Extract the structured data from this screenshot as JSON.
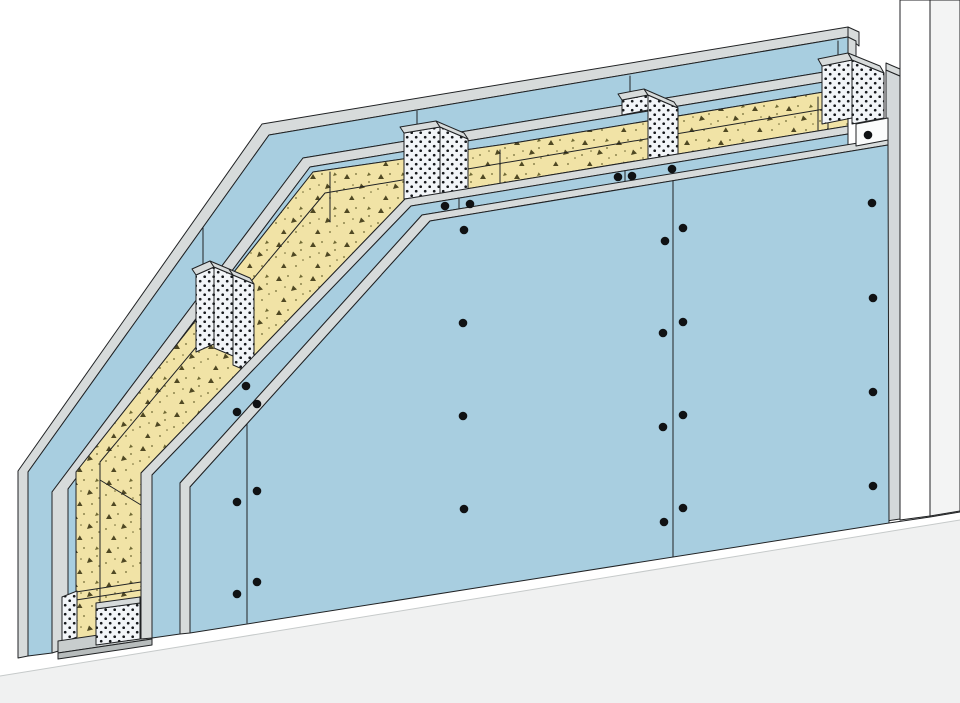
{
  "figure": {
    "kind": "technical-cutaway-diagram",
    "subject": "drywall-partition-wall-assembly",
    "canvas": {
      "width": 960,
      "height": 703
    }
  },
  "colors": {
    "outline": "#202224",
    "board": "#a8cee0",
    "edge": "#d7dbdb",
    "insulation": "#f1e3a6",
    "speckle": "#4f4823",
    "speckleDot": "#6f6833",
    "studBg": "#f2f5f8",
    "studDot": "#16191c",
    "wallStrip": "#d3d8da",
    "reveal": "#ffffff",
    "wallFace": "#f3f4f4",
    "floorWhite": "#ffffff",
    "floorGray": "#f0f1f1",
    "floorLine": "#c6caca",
    "track": "#c8cdcd",
    "trackDark": "#b7bcbc",
    "boxWhite": "#fbfcfc",
    "screw": "#101214"
  },
  "illustration": {
    "layers": [
      {
        "name": "existing-wall",
        "shapes": [
          {
            "name": "existing-wall-reveal",
            "type": "polygon",
            "points": "900,0 930,0 930,516 900,520",
            "fill": "reveal"
          },
          {
            "name": "existing-wall-face",
            "type": "polygon",
            "points": "930,0 960,0 960,511 930,516",
            "fill": "wallFace"
          },
          {
            "name": "existing-wall-edge-strip",
            "type": "polygon",
            "points": "886,70 900,76 900,519 886,521",
            "fill": "wallStrip"
          },
          {
            "name": "existing-wall-edge-cap",
            "type": "polygon",
            "points": "886,70 900,76 900,69 886,63",
            "fill": "edge"
          }
        ]
      },
      {
        "name": "floor",
        "shapes": [
          {
            "name": "floor-white-band",
            "type": "polygon",
            "points": "20,658 190,633 889,523 930,517 960,512 960,520 0,676",
            "fill": "floorWhite",
            "stroke": "none"
          },
          {
            "name": "floor-gray-area",
            "type": "polygon",
            "points": "0,676 960,520 960,703 0,703",
            "fill": "floorGray",
            "stroke": "none"
          },
          {
            "name": "floor-edge-line",
            "type": "polyline",
            "points": "889,523 930,517 960,512",
            "fill": "none"
          },
          {
            "name": "floor-zone-line",
            "type": "polyline",
            "points": "0,676 960,520",
            "fill": "none",
            "stroke": "floorLine"
          }
        ]
      },
      {
        "name": "back-boards",
        "shapes": [
          {
            "name": "back-outer-board-top-edge",
            "type": "polygon",
            "points": "848,27 262,124 18,471 18,658 28,656 28,472 269,135 848,37",
            "fill": "edge"
          },
          {
            "name": "back-outer-board-face",
            "type": "polygon",
            "points": "848,37 269,135 28,472 28,656 52,653 52,492 303,158 848,68",
            "fill": "board"
          },
          {
            "name": "back-board-joint-1",
            "type": "polyline",
            "points": "417,111 417,131",
            "fill": "none"
          },
          {
            "name": "back-board-joint-2",
            "type": "polyline",
            "points": "630,76 630,96",
            "fill": "none"
          },
          {
            "name": "back-board-joint-3",
            "type": "polyline",
            "points": "838,41 838,57",
            "fill": "none"
          },
          {
            "name": "back-board-joint-4",
            "type": "polyline",
            "points": "203,228 203,275",
            "fill": "none"
          },
          {
            "name": "back-inner-board-top-edge",
            "type": "polygon",
            "points": "848,68 303,158 52,492 52,653 68,648 68,489 310,167 848,78",
            "fill": "edge"
          },
          {
            "name": "back-inner-board-face",
            "type": "polygon",
            "points": "848,78 310,167 68,489 68,648 76,646 76,472 313,172 520,142 848,88",
            "fill": "board"
          }
        ]
      },
      {
        "name": "insulation",
        "shapes": [
          {
            "name": "mineral-wool-band",
            "type": "polygon",
            "points": "848,88 520,142 313,172 76,472 76,640 141,640 141,473 405,199 848,126",
            "fill": "insulPattern"
          },
          {
            "name": "mineral-wool-arris-line",
            "type": "polyline",
            "points": "848,105 325,193 100,462 100,618",
            "fill": "none"
          },
          {
            "name": "mineral-wool-fold-line",
            "type": "polyline",
            "points": "330,172 330,222",
            "fill": "none"
          },
          {
            "name": "batt-joint-1",
            "type": "polyline",
            "points": "500,150 500,183",
            "fill": "none"
          },
          {
            "name": "batt-joint-2",
            "type": "polyline",
            "points": "818,97 818,130",
            "fill": "none"
          },
          {
            "name": "batt-joint-3",
            "type": "polyline",
            "points": "828,96 828,129",
            "fill": "none"
          },
          {
            "name": "batt-joint-4",
            "type": "polyline",
            "points": "100,480 141,505",
            "fill": "none"
          },
          {
            "name": "batt-end-line-1",
            "type": "polyline",
            "points": "76,592 141,582",
            "fill": "none"
          },
          {
            "name": "batt-end-line-2",
            "type": "polyline",
            "points": "76,600 141,590",
            "fill": "none"
          }
        ]
      },
      {
        "name": "studs",
        "shapes": [
          {
            "name": "stud-left-flange",
            "type": "polygon",
            "points": "196,275 214,267 214,344 196,352",
            "fill": "studPattern"
          },
          {
            "name": "stud-left-web",
            "type": "polygon",
            "points": "214,267 233,275 233,356 214,348",
            "fill": "studPattern"
          },
          {
            "name": "stud-left-flange-2",
            "type": "polygon",
            "points": "233,275 254,284 254,374 233,365",
            "fill": "studPattern"
          },
          {
            "name": "stud-left-cap-1",
            "type": "polygon",
            "points": "196,275 214,267 210,261 192,269",
            "fill": "edge"
          },
          {
            "name": "stud-left-cap-2",
            "type": "polygon",
            "points": "214,267 233,275 229,269 210,261",
            "fill": "edge"
          },
          {
            "name": "stud-left-cap-3",
            "type": "polygon",
            "points": "233,275 254,284 250,278 229,269",
            "fill": "edge"
          },
          {
            "name": "stud-mid-flange",
            "type": "polygon",
            "points": "404,133 440,127 440,194 404,199",
            "fill": "studPattern"
          },
          {
            "name": "stud-mid-web",
            "type": "polygon",
            "points": "440,127 468,139 468,189 440,194",
            "fill": "studPattern"
          },
          {
            "name": "stud-mid-cap-1",
            "type": "polygon",
            "points": "404,133 440,127 436,121 400,127",
            "fill": "edge"
          },
          {
            "name": "stud-mid-cap-2",
            "type": "polygon",
            "points": "440,127 468,139 464,133 436,121",
            "fill": "edge"
          },
          {
            "name": "stud-right-flange",
            "type": "polygon",
            "points": "622,100 648,95 648,110 622,115",
            "fill": "studPattern"
          },
          {
            "name": "stud-right-web",
            "type": "polygon",
            "points": "648,95 678,108 678,154 648,159",
            "fill": "studPattern"
          },
          {
            "name": "stud-right-cap-1",
            "type": "polygon",
            "points": "622,100 648,95 644,89 618,94",
            "fill": "edge"
          },
          {
            "name": "stud-right-cap-2",
            "type": "polygon",
            "points": "648,95 678,108 674,102 644,89",
            "fill": "edge"
          }
        ]
      },
      {
        "name": "floor-track",
        "shapes": [
          {
            "name": "track-back-flange",
            "type": "polygon",
            "points": "62,597 77,591 77,637 62,643",
            "fill": "studPattern"
          },
          {
            "name": "track-web",
            "type": "polygon",
            "points": "58,641 152,627 152,639 58,653",
            "fill": "track"
          },
          {
            "name": "track-front-lip",
            "type": "polygon",
            "points": "58,653 152,639 152,645 58,659",
            "fill": "trackDark"
          },
          {
            "name": "stud-base-section",
            "type": "polygon",
            "points": "96,609 140,603 140,639 96,645",
            "fill": "studPattern"
          },
          {
            "name": "stud-base-cap",
            "type": "polygon",
            "points": "96,609 140,603 140,597 96,603",
            "fill": "edge"
          }
        ]
      },
      {
        "name": "front-boards",
        "shapes": [
          {
            "name": "front-inner-board-top-edge",
            "type": "polygon",
            "points": "848,126 405,199 141,473 141,639 152,638 152,475 411,206 848,134",
            "fill": "edge"
          },
          {
            "name": "front-inner-board-face",
            "type": "polygon",
            "points": "848,134 411,206 152,475 152,638 180,634 180,483 422,215 848,145",
            "fill": "board"
          },
          {
            "name": "inner-board-joint-1",
            "type": "polyline",
            "points": "459,198 459,209",
            "fill": "none"
          },
          {
            "name": "inner-board-joint-2",
            "type": "polyline",
            "points": "625,171 625,181",
            "fill": "none"
          },
          {
            "name": "front-outer-board-top-edge",
            "type": "polygon",
            "points": "888,138 422,215 180,483 180,634 190,633 190,487 430,221 888,145",
            "fill": "edge"
          },
          {
            "name": "front-outer-board-face",
            "type": "polygon",
            "points": "888,145 430,221 190,487 190,633 889,523",
            "fill": "board"
          },
          {
            "name": "outer-board-joint-left",
            "type": "polyline",
            "points": "247,424 247,623",
            "fill": "none"
          },
          {
            "name": "outer-board-joint-right",
            "type": "polyline",
            "points": "673,181 673,557",
            "fill": "none"
          }
        ]
      },
      {
        "name": "wall-connection",
        "shapes": [
          {
            "name": "band-end-cap-1",
            "type": "polygon",
            "points": "848,27 859,32 859,46 848,37",
            "fill": "edge"
          },
          {
            "name": "band-end-cap-2",
            "type": "polygon",
            "points": "848,37 856,41 856,85 848,80",
            "fill": "edge"
          },
          {
            "name": "corner-stud-left-face",
            "type": "polygon",
            "points": "822,66 852,60 852,118 822,124",
            "fill": "studPattern"
          },
          {
            "name": "corner-stud-right-face",
            "type": "polygon",
            "points": "852,60 884,73 884,118 852,124",
            "fill": "studPattern"
          },
          {
            "name": "corner-stud-cap-1",
            "type": "polygon",
            "points": "822,66 852,60 848,53 818,59",
            "fill": "edge"
          },
          {
            "name": "corner-stud-cap-2",
            "type": "polygon",
            "points": "852,60 884,73 880,66 848,53",
            "fill": "edge"
          },
          {
            "name": "connection-bracket",
            "type": "polygon",
            "points": "856,124 888,118 888,140 856,146",
            "fill": "boxWhite"
          }
        ]
      }
    ]
  },
  "screws": {
    "radius": 4.3,
    "positions": [
      [
        445,
        206
      ],
      [
        470,
        204
      ],
      [
        618,
        177
      ],
      [
        632,
        176
      ],
      [
        672,
        169
      ],
      [
        246,
        386
      ],
      [
        237,
        412
      ],
      [
        237,
        502
      ],
      [
        237,
        594
      ],
      [
        257,
        404
      ],
      [
        257,
        491
      ],
      [
        257,
        582
      ],
      [
        464,
        230
      ],
      [
        463,
        323
      ],
      [
        463,
        416
      ],
      [
        464,
        509
      ],
      [
        665,
        241
      ],
      [
        683,
        228
      ],
      [
        663,
        333
      ],
      [
        683,
        322
      ],
      [
        663,
        427
      ],
      [
        683,
        415
      ],
      [
        664,
        522
      ],
      [
        683,
        508
      ],
      [
        872,
        203
      ],
      [
        873,
        298
      ],
      [
        873,
        392
      ],
      [
        873,
        486
      ],
      [
        868,
        135
      ]
    ]
  }
}
